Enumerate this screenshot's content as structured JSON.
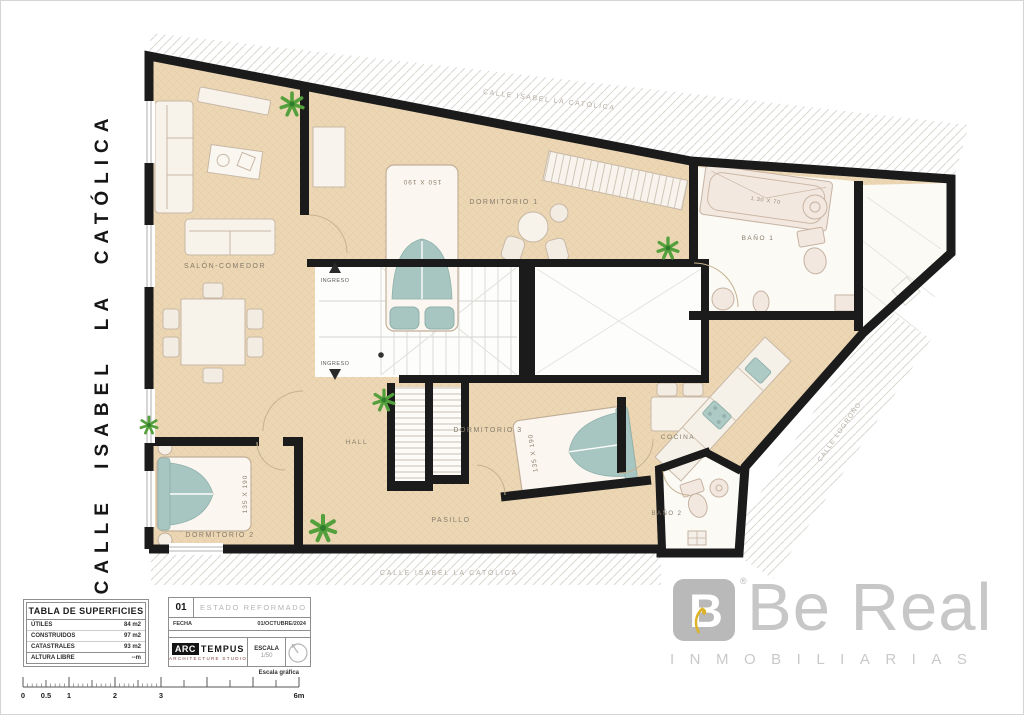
{
  "colors": {
    "wall": "#1b1b1b",
    "floor": "#ecd7b5",
    "accent_teal": "#a7c5c1",
    "plant_green": "#54a03c",
    "brand_gray": "#b9b9b9",
    "leaf_yellow": "#dcb32a"
  },
  "streets": {
    "left": "CALLE ISABEL LA CATÓLICA",
    "top": "CALLE ISABEL LA CATÓLICA",
    "bottom": "CALLE ISABEL LA CATÓLICA",
    "right": "CALLE LOGROÑO"
  },
  "rooms": {
    "salon": "SALÓN-COMEDOR",
    "dormitorio1": "DORMITORIO 1",
    "dormitorio2": "DORMITORIO 2",
    "dormitorio3": "DORMITORIO 3",
    "hall": "HALL",
    "pasillo": "PASILLO",
    "cocina": "COCINA",
    "bano1": "BAÑO 1",
    "bano2": "BAÑO 2"
  },
  "labels": {
    "ingreso": "INGRESO",
    "bed_150": "150 X 190",
    "bed_135": "135 X 190",
    "bathtub": "1.30 X 70"
  },
  "tabla": {
    "title": "TABLA DE SUPERFICIES",
    "rows": [
      {
        "label": "ÚTILES",
        "value": "84 m2"
      },
      {
        "label": "CONSTRUIDOS",
        "value": "97 m2"
      },
      {
        "label": "CATASTRALES",
        "value": "93 m2"
      },
      {
        "label": "ALTURA LIBRE",
        "value": "--m"
      }
    ]
  },
  "titleblock": {
    "sheet_number": "01",
    "estado": "ESTADO REFORMADO",
    "fecha_label": "FECHA",
    "fecha_value": "01/OCTUBRE/2024",
    "studio_arc": "ARC",
    "studio_tempus": "TEMPUS",
    "studio_subtitle": "ARCHITECTURE STUDIO",
    "escala_label": "ESCALA",
    "escala_value": "1/50"
  },
  "brand": {
    "monogram": "B",
    "registered": "®",
    "name": "Be Real",
    "subtitle": "INMOBILIARIAS"
  },
  "scalebar": {
    "caption": "Escala gráfica",
    "ticks": [
      "0",
      "0.5",
      "1",
      "2",
      "3",
      "6m"
    ]
  }
}
